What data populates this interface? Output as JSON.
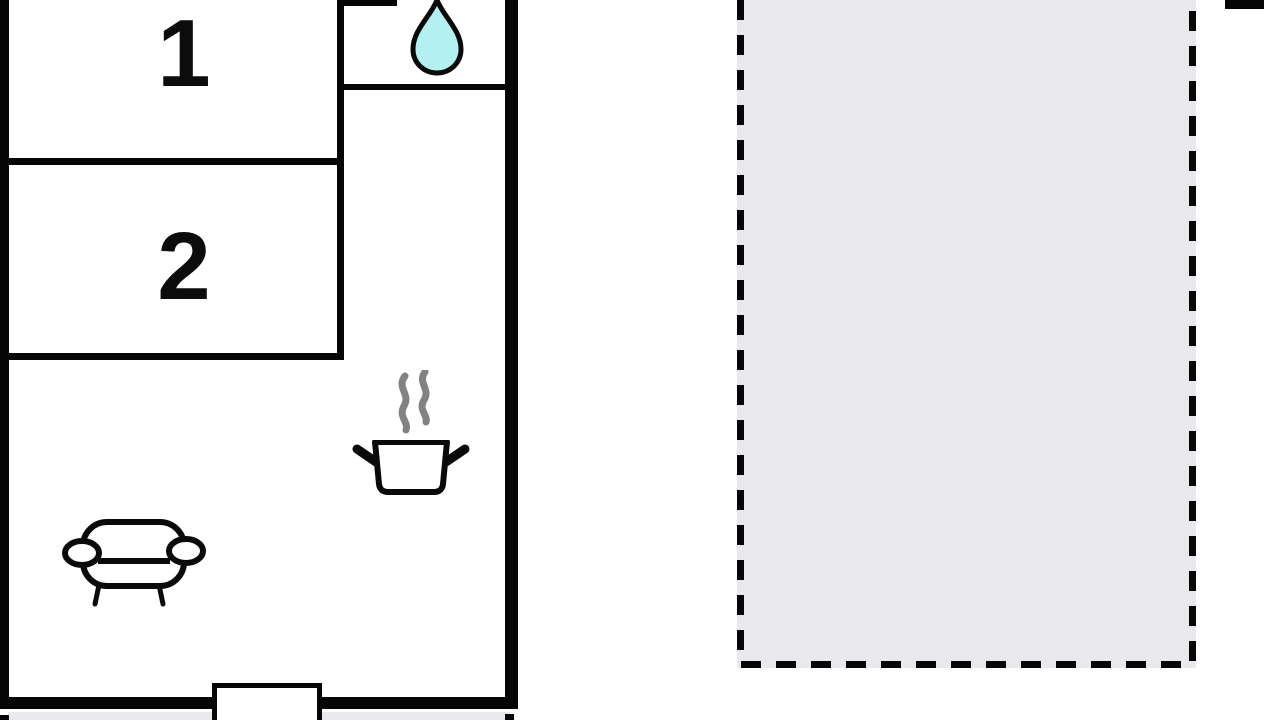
{
  "page": {
    "background": "#ffffff",
    "type_hint": "apartment floor plan with terrace"
  },
  "floor_plan": {
    "room_labels": {
      "room1": "1",
      "room2": "2"
    },
    "icons": {
      "water_drop": "water-drop-icon",
      "steam": "steam-icon",
      "cooking_pot": "cooking-pot-icon",
      "sofa": "sofa-icon"
    },
    "colors": {
      "wall": "#060606",
      "line": "#0a0a0a",
      "water-drop-fill": "#b3f1f0",
      "terrace-fill": "#e9e8ec",
      "steam": "#828282",
      "background": "#ffffff"
    }
  }
}
